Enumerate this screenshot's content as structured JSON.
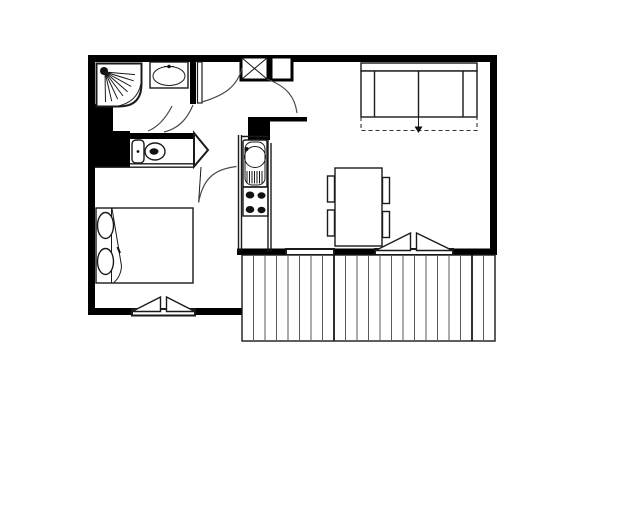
{
  "page": {
    "title": "Apartment floor plan",
    "background": "#ffffff"
  },
  "plan": {
    "type": "architectural floor plan",
    "style": "black and white line drawing, no text labels",
    "colors": {
      "walls": "#000000",
      "lines": "#1a1a1a",
      "fill": "#ffffff"
    },
    "rooms": {
      "bathroom": "Bathroom",
      "wc": "WC niche",
      "hallway": "Entrance hall",
      "bedroom": "Bedroom",
      "kitchen": "Kitchenette",
      "living_room": "Living room",
      "balcony": "Balcony"
    },
    "fixtures": {
      "shower": "Corner shower with shower head",
      "washbasin": "Washbasin",
      "toilet": "Toilet",
      "storage_x": "Built-in closet (crossed square)",
      "storage_plain": "Built-in cupboard",
      "entry_door": "Entry door with swing arc",
      "bathroom_door": "Bathroom door swing arc",
      "bedroom_door": "Bedroom door with swing arc",
      "living_room_door": "Living room door swing arc",
      "kitchen_sink": "Kitchen sink with drainer",
      "stove": "Four-burner stove",
      "counter": "Kitchen counter",
      "sofa_bed": "Two-seat pull-out sofa bed",
      "pullout_arrow": "Sofa bed pull-out direction arrow",
      "dining_table": "Dining table",
      "chairs": "Four dining chairs",
      "bed": "Double bed with folded duvet",
      "pillows": "Two pillows",
      "bedroom_window": "Bedroom casement window",
      "living_room_window_fixed": "Living room window",
      "living_room_window_casement": "Living room casement window",
      "balcony_deck": "Balcony wooden decking"
    }
  }
}
